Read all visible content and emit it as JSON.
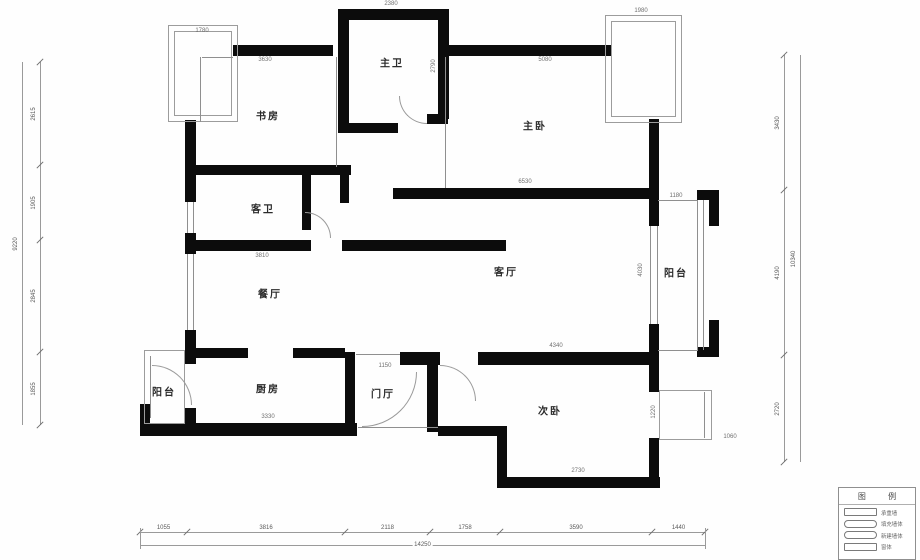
{
  "palette": {
    "wall": "#0c0c0c",
    "thin_line": "#8f8f8f",
    "dim_text": "#5a5a5a",
    "room_text": "#2b2b2b",
    "background": "#fefefe"
  },
  "rooms": [
    {
      "id": "study",
      "label": "书房",
      "x": 268,
      "y": 115
    },
    {
      "id": "master-bath",
      "label": "主卫",
      "x": 392,
      "y": 62
    },
    {
      "id": "master-bedroom",
      "label": "主卧",
      "x": 535,
      "y": 125
    },
    {
      "id": "guest-bath",
      "label": "客卫",
      "x": 263,
      "y": 208
    },
    {
      "id": "dining",
      "label": "餐厅",
      "x": 270,
      "y": 293
    },
    {
      "id": "living",
      "label": "客厅",
      "x": 506,
      "y": 271
    },
    {
      "id": "balcony-east",
      "label": "阳台",
      "x": 676,
      "y": 272
    },
    {
      "id": "balcony-west",
      "label": "阳台",
      "x": 164,
      "y": 391
    },
    {
      "id": "kitchen",
      "label": "厨房",
      "x": 268,
      "y": 388
    },
    {
      "id": "foyer",
      "label": "门厅",
      "x": 383,
      "y": 393
    },
    {
      "id": "second-bedroom",
      "label": "次卧",
      "x": 550,
      "y": 410
    }
  ],
  "legend": {
    "title": "图  例",
    "items": [
      {
        "label": "承重墙",
        "shape": "rect"
      },
      {
        "label": "填充墙体",
        "shape": "round"
      },
      {
        "label": "新建墙体",
        "shape": "round"
      },
      {
        "label": "窗体",
        "shape": "rect"
      }
    ]
  },
  "geometry": {
    "walls": [
      [
        233,
        45,
        100,
        11
      ],
      [
        338,
        9,
        110,
        11
      ],
      [
        338,
        9,
        11,
        124
      ],
      [
        438,
        9,
        11,
        110
      ],
      [
        427,
        114,
        21,
        10
      ],
      [
        340,
        123,
        58,
        10
      ],
      [
        443,
        45,
        169,
        11
      ],
      [
        185,
        120,
        11,
        82
      ],
      [
        185,
        233,
        11,
        21
      ],
      [
        185,
        330,
        11,
        34
      ],
      [
        185,
        408,
        11,
        27
      ],
      [
        185,
        165,
        166,
        10
      ],
      [
        302,
        175,
        9,
        55
      ],
      [
        340,
        175,
        9,
        28
      ],
      [
        185,
        240,
        126,
        11
      ],
      [
        342,
        240,
        164,
        11
      ],
      [
        393,
        188,
        266,
        11
      ],
      [
        649,
        119,
        10,
        107
      ],
      [
        649,
        324,
        10,
        67
      ],
      [
        697,
        190,
        22,
        10
      ],
      [
        709,
        190,
        10,
        36
      ],
      [
        709,
        320,
        10,
        37
      ],
      [
        697,
        347,
        22,
        10
      ],
      [
        478,
        352,
        181,
        13
      ],
      [
        400,
        352,
        40,
        13
      ],
      [
        345,
        352,
        10,
        79
      ],
      [
        427,
        352,
        11,
        80
      ],
      [
        195,
        348,
        53,
        10
      ],
      [
        293,
        348,
        52,
        10
      ],
      [
        140,
        423,
        217,
        13
      ],
      [
        140,
        404,
        10,
        32
      ],
      [
        438,
        426,
        66,
        10
      ],
      [
        497,
        426,
        10,
        62
      ],
      [
        497,
        477,
        163,
        11
      ],
      [
        649,
        356,
        10,
        36
      ],
      [
        649,
        438,
        10,
        50
      ]
    ],
    "outlines": [
      [
        168,
        25,
        70,
        97
      ],
      [
        174,
        31,
        58,
        85
      ],
      [
        605,
        15,
        77,
        108
      ],
      [
        611,
        21,
        65,
        96
      ],
      [
        144,
        350,
        41,
        74
      ],
      [
        659,
        390,
        53,
        50
      ]
    ],
    "lines": [
      [
        200,
        57,
        1,
        65
      ],
      [
        202,
        57,
        31,
        1
      ],
      [
        336,
        57,
        1,
        110
      ],
      [
        445,
        57,
        1,
        131
      ],
      [
        658,
        200,
        40,
        1
      ],
      [
        658,
        350,
        40,
        1
      ],
      [
        697,
        200,
        1,
        150
      ],
      [
        703,
        200,
        1,
        150
      ],
      [
        650,
        226,
        1,
        98
      ],
      [
        657,
        226,
        1,
        98
      ],
      [
        187,
        202,
        1,
        31
      ],
      [
        193,
        202,
        1,
        31
      ],
      [
        187,
        254,
        1,
        76
      ],
      [
        193,
        254,
        1,
        76
      ],
      [
        150,
        356,
        1,
        62
      ],
      [
        704,
        392,
        1,
        46
      ],
      [
        356,
        354,
        44,
        1
      ],
      [
        358,
        427,
        80,
        1
      ]
    ],
    "arcs": [
      [
        399,
        96,
        28,
        "bl"
      ],
      [
        152,
        365,
        40,
        "tr"
      ],
      [
        362,
        372,
        55,
        "br"
      ],
      [
        305,
        212,
        26,
        "tr"
      ],
      [
        440,
        365,
        36,
        "tr"
      ]
    ]
  },
  "annotations": [
    {
      "x": 265,
      "y": 60,
      "t": "3630"
    },
    {
      "x": 545,
      "y": 60,
      "t": "5080"
    },
    {
      "x": 525,
      "y": 182,
      "t": "6530"
    },
    {
      "x": 556,
      "y": 346,
      "t": "4340"
    },
    {
      "x": 262,
      "y": 256,
      "t": "3810"
    },
    {
      "x": 268,
      "y": 417,
      "t": "3330"
    },
    {
      "x": 578,
      "y": 471,
      "t": "2730"
    },
    {
      "x": 385,
      "y": 366,
      "t": "1150"
    },
    {
      "x": 676,
      "y": 196,
      "t": "1180"
    },
    {
      "x": 730,
      "y": 437,
      "t": "1060"
    },
    {
      "x": 391,
      "y": 4,
      "t": "2380"
    },
    {
      "x": 641,
      "y": 11,
      "t": "1980"
    },
    {
      "x": 202,
      "y": 31,
      "t": "1780"
    },
    {
      "x": 434,
      "y": 66,
      "t": "2790",
      "v": true
    },
    {
      "x": 641,
      "y": 270,
      "t": "4030",
      "v": true
    },
    {
      "x": 654,
      "y": 412,
      "t": "1220",
      "v": true
    }
  ],
  "dimensions": {
    "bottom": {
      "y_segments": 532,
      "y_total": 545,
      "x_start": 140,
      "x_end": 705,
      "ticks": [
        140,
        187,
        345,
        430,
        500,
        652,
        705
      ],
      "segments": [
        "1055",
        "3816",
        "2118",
        "1758",
        "3590",
        "1440"
      ],
      "total": "14250"
    },
    "left": {
      "x_total": 22,
      "x_segments": 40,
      "y_start": 62,
      "y_end": 425,
      "ticks": [
        62,
        165,
        240,
        352,
        425
      ],
      "segments": [
        "2615",
        "1905",
        "2845",
        "1855"
      ],
      "total": "9220"
    },
    "right": {
      "x_total": 800,
      "x_segments": 784,
      "y_start": 55,
      "y_end": 462,
      "ticks": [
        55,
        190,
        355,
        462
      ],
      "segments": [
        "3430",
        "4190",
        "2720"
      ],
      "total": "10340"
    }
  }
}
